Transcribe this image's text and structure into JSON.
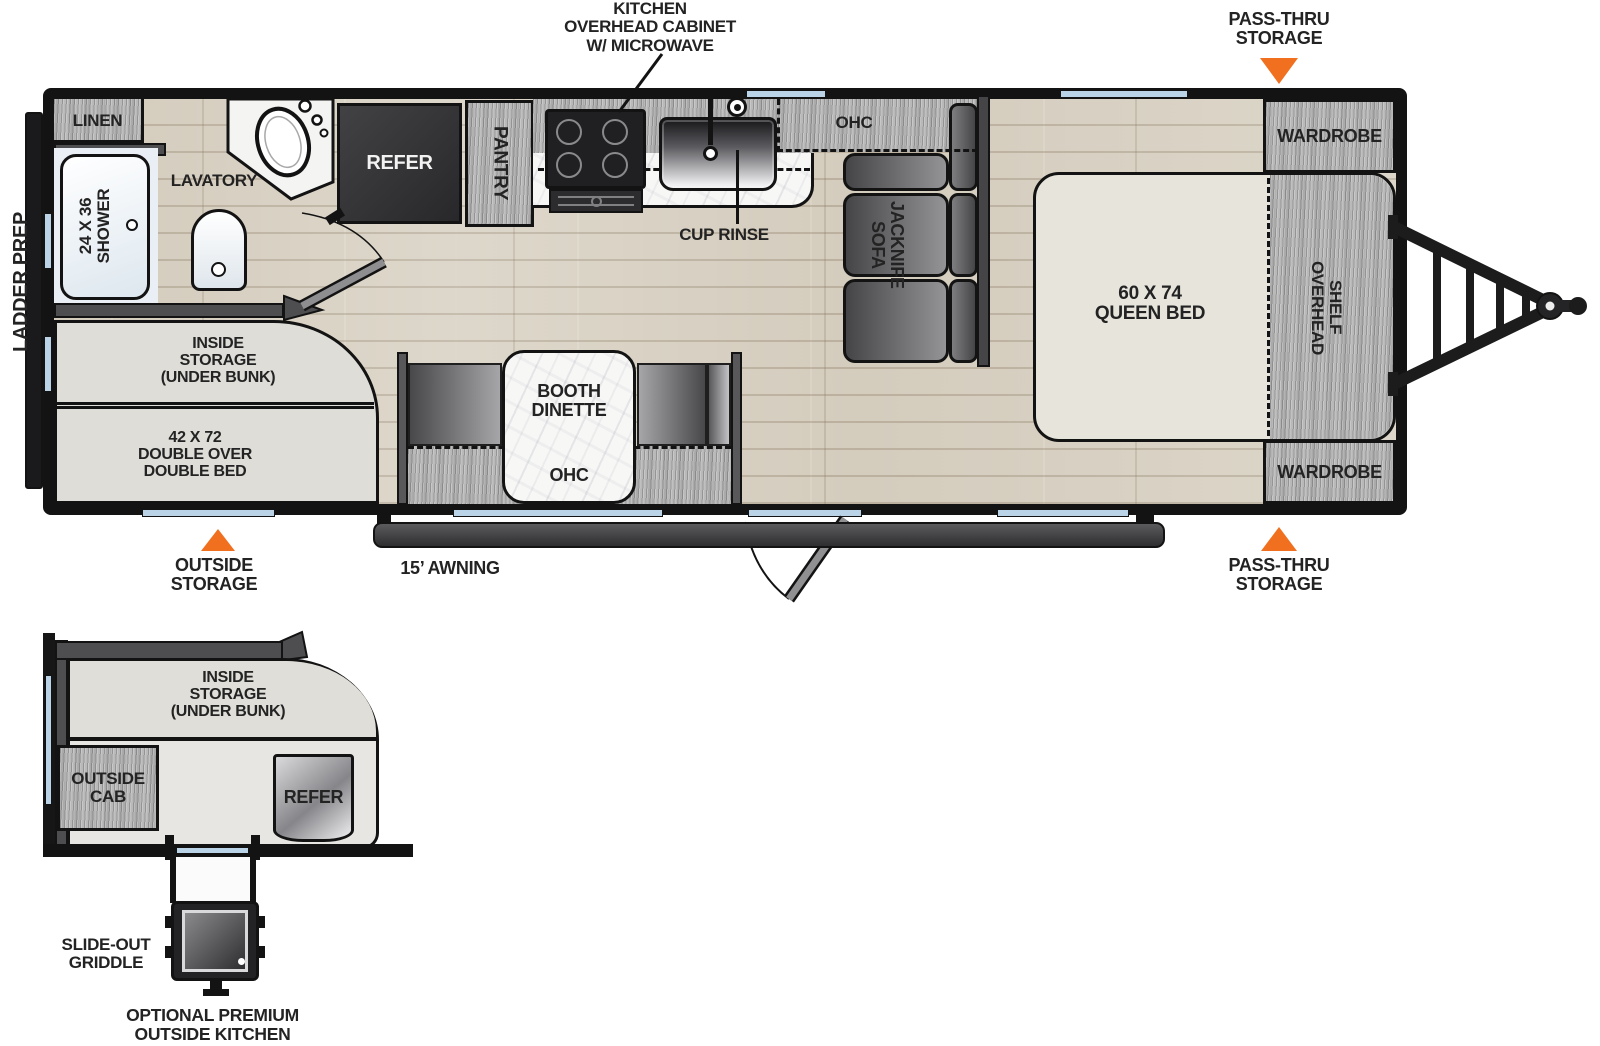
{
  "colors": {
    "accent_orange": "#F0701F",
    "wall": "#131313",
    "window_blue": "#bad3e6"
  },
  "main_plan": {
    "callouts": {
      "kitchen_cabinet": [
        "KITCHEN",
        "OVERHEAD CABINET",
        "W/ MICROWAVE"
      ],
      "pass_thru_top": [
        "PASS-THRU",
        "STORAGE"
      ],
      "pass_thru_bottom": [
        "PASS-THRU",
        "STORAGE"
      ],
      "outside_storage": [
        "OUTSIDE",
        "STORAGE"
      ],
      "ladder_prep": "LADDER PREP",
      "awning": "15’ AWNING",
      "cup_rinse": "CUP RINSE"
    },
    "labels": {
      "linen": "LINEN",
      "shower": [
        "24 X 36",
        "SHOWER"
      ],
      "lavatory": "LAVATORY",
      "refer": "REFER",
      "pantry": "PANTRY",
      "ohc_kitchen": "OHC",
      "jacknife_sofa": [
        "JACKNIFE",
        "SOFA"
      ],
      "queen_bed": [
        "60 X 74",
        "QUEEN BED"
      ],
      "overhead_shelf": [
        "OVERHEAD",
        "SHELF"
      ],
      "wardrobe_top": "WARDROBE",
      "wardrobe_bottom": "WARDROBE",
      "inside_storage": [
        "INSIDE",
        "STORAGE",
        "(UNDER BUNK)"
      ],
      "double_bed": [
        "42 X 72",
        "DOUBLE OVER",
        "DOUBLE BED"
      ],
      "booth_dinette": [
        "BOOTH",
        "DINETTE"
      ],
      "ohc_dinette": "OHC"
    }
  },
  "optional_plan": {
    "labels": {
      "inside_storage": [
        "INSIDE",
        "STORAGE",
        "(UNDER BUNK)"
      ],
      "outside_cab": [
        "OUTSIDE",
        "CAB"
      ],
      "refer": "REFER"
    },
    "callouts": {
      "slide_out_griddle": [
        "SLIDE-OUT",
        "GRIDDLE"
      ],
      "caption": [
        "OPTIONAL PREMIUM",
        "OUTSIDE KITCHEN"
      ]
    }
  }
}
